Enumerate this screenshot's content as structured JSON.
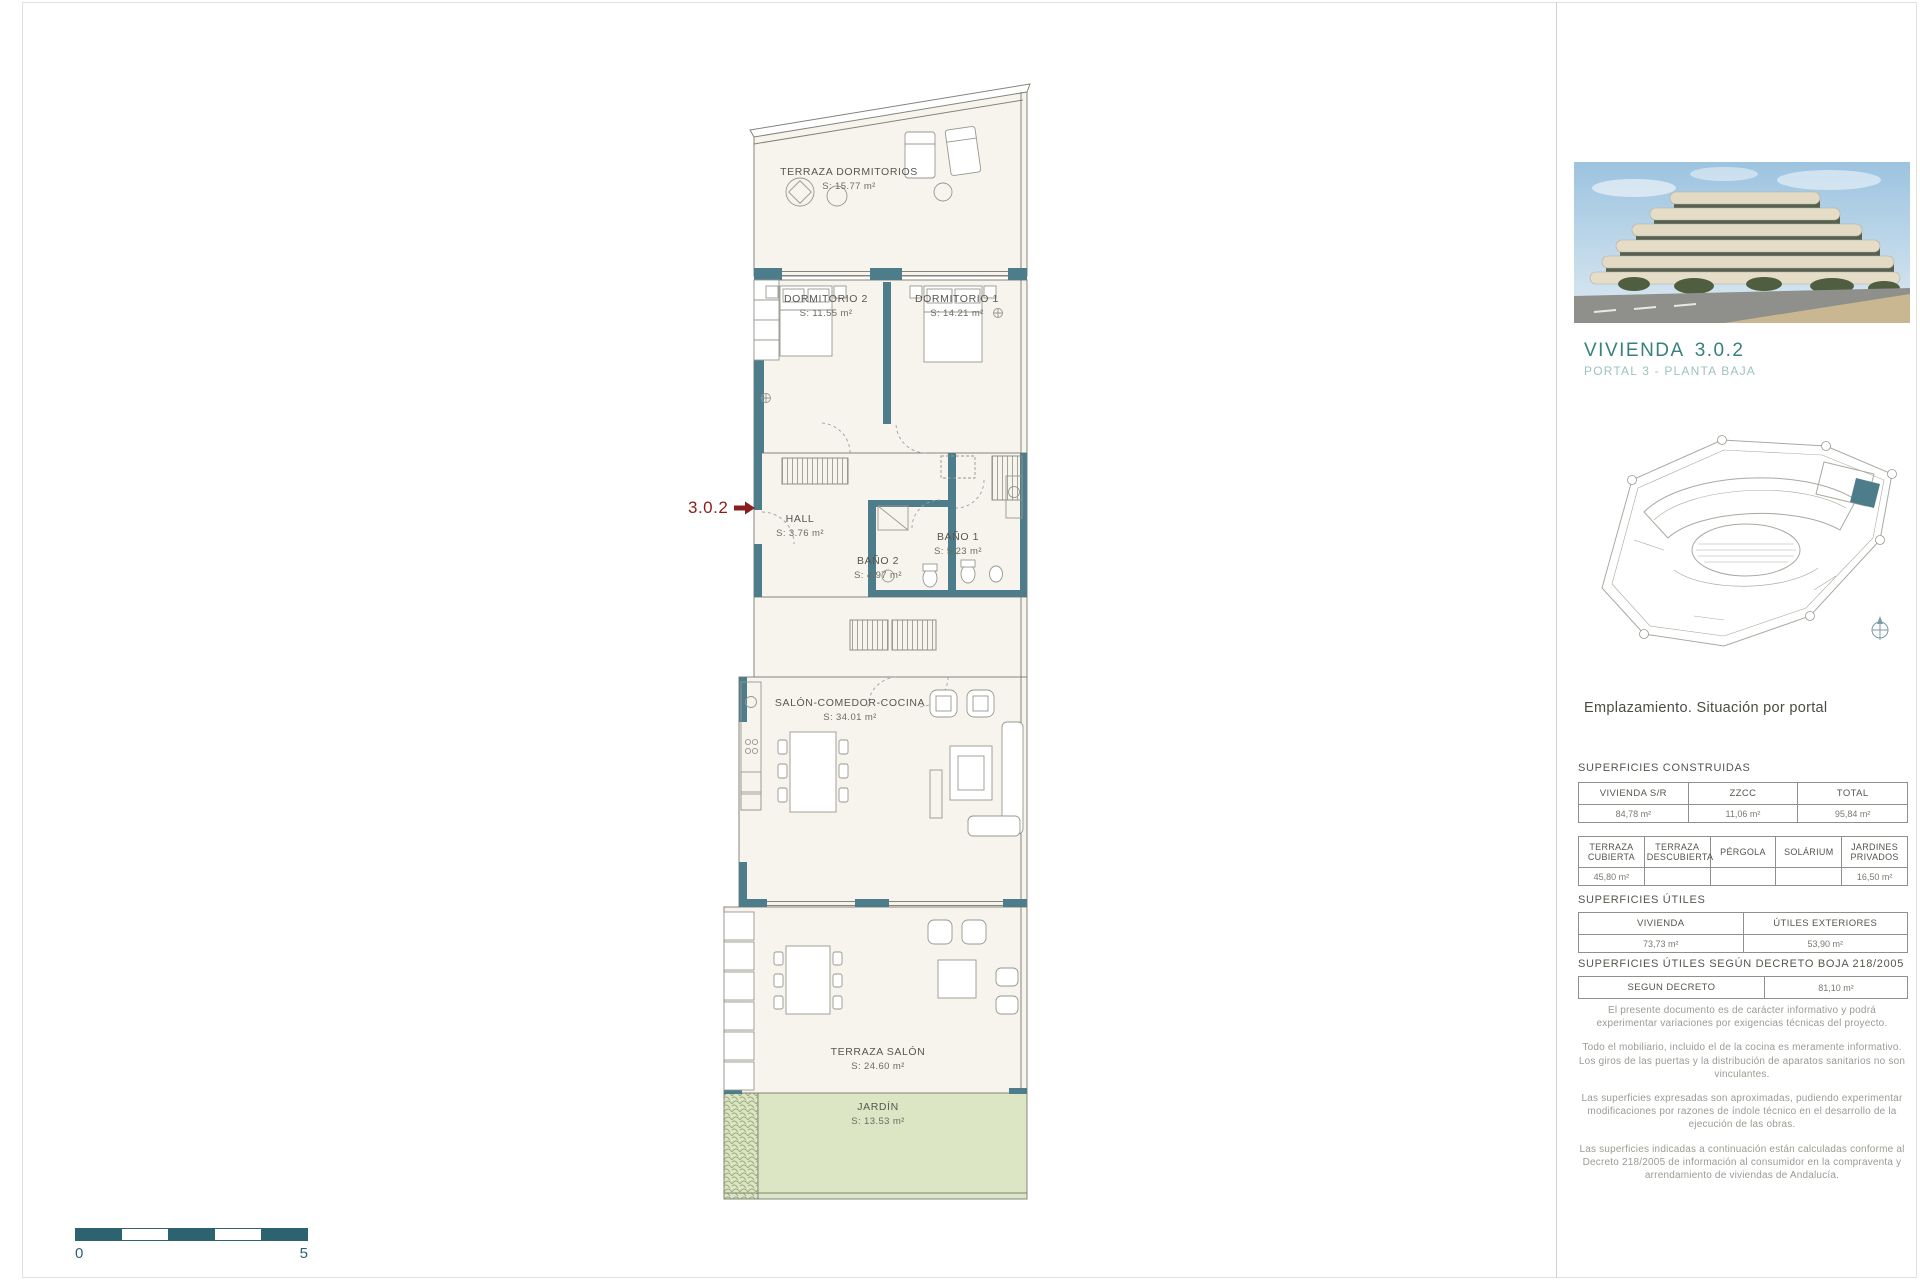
{
  "floor_plan": {
    "unit_marker": {
      "label": "3.0.2",
      "color": "#8c1d1d"
    },
    "rooms": [
      {
        "id": "terraza-dormitorios",
        "name": "TERRAZA DORMITORIOS",
        "area": "S: 15.77 m²"
      },
      {
        "id": "dormitorio-2",
        "name": "DORMITORIO 2",
        "area": "S: 11.55 m²"
      },
      {
        "id": "dormitorio-1",
        "name": "DORMITORIO 1",
        "area": "S: 14.21 m²"
      },
      {
        "id": "hall",
        "name": "HALL",
        "area": "S: 3.76 m²"
      },
      {
        "id": "bano-2",
        "name": "BAÑO 2",
        "area": "S: 4.97 m²"
      },
      {
        "id": "bano-1",
        "name": "BAÑO 1",
        "area": "S: 5.23 m²"
      },
      {
        "id": "salon-comedor-cocina",
        "name": "SALÓN-COMEDOR-COCINA",
        "area": "S: 34.01 m²"
      },
      {
        "id": "terraza-salon",
        "name": "TERRAZA SALÓN",
        "area": "S: 24.60 m²"
      },
      {
        "id": "jardin",
        "name": "JARDÍN",
        "area": "S: 13.53 m²"
      }
    ],
    "scale_bar": {
      "start_label": "0",
      "end_label": "5",
      "color": "#2d6371"
    }
  },
  "sidebar": {
    "unit_title": "VIVIENDA",
    "unit_number": "3.0.2",
    "unit_subtitle": "PORTAL 3 - PLANTA BAJA",
    "site_caption": "Emplazamiento. Situación por portal",
    "colors": {
      "title_teal": "#37807c",
      "wall_teal": "#4d7d8a",
      "garden_green": "#dde6c4"
    },
    "sections": {
      "construidas": {
        "heading": "SUPERFICIES CONSTRUIDAS",
        "table1": {
          "headers": [
            "VIVIENDA S/R",
            "ZZCC",
            "TOTAL"
          ],
          "values": [
            "84,78 m²",
            "11,06 m²",
            "95,84 m²"
          ]
        },
        "table2": {
          "headers": [
            "TERRAZA CUBIERTA",
            "TERRAZA DESCUBIERTA",
            "PÉRGOLA",
            "SOLÁRIUM",
            "JARDINES PRIVADOS"
          ],
          "values": [
            "45,80 m²",
            "",
            "",
            "",
            "16,50 m²"
          ]
        }
      },
      "utiles": {
        "heading": "SUPERFICIES ÚTILES",
        "table": {
          "headers": [
            "VIVIENDA",
            "ÚTILES EXTERIORES"
          ],
          "values": [
            "73,73 m²",
            "53,90 m²"
          ]
        }
      },
      "decreto": {
        "heading": "SUPERFICIES ÚTILES SEGÚN DECRETO BOJA 218/2005",
        "table": {
          "headers": [
            "SEGUN DECRETO"
          ],
          "values": [
            "81,10 m²"
          ]
        }
      }
    },
    "disclaimers": [
      "El presente documento es de carácter informativo y podrá experimentar variaciones por exigencias técnicas del  proyecto.",
      "Todo el mobiliario, incluido el de la cocina es meramente informativo. Los giros de las puertas y la distribución de aparatos sanitarios no son vinculantes.",
      "Las superficies expresadas son aproximadas, pudiendo experimentar modificaciones por razones de índole técnico en el desarrollo de la ejecución de las obras.",
      "Las superficies indicadas a continuación están calculadas conforme al Decreto 218/2005 de información al consumidor en la compraventa  y arrendamiento de viviendas de Andalucía."
    ]
  }
}
